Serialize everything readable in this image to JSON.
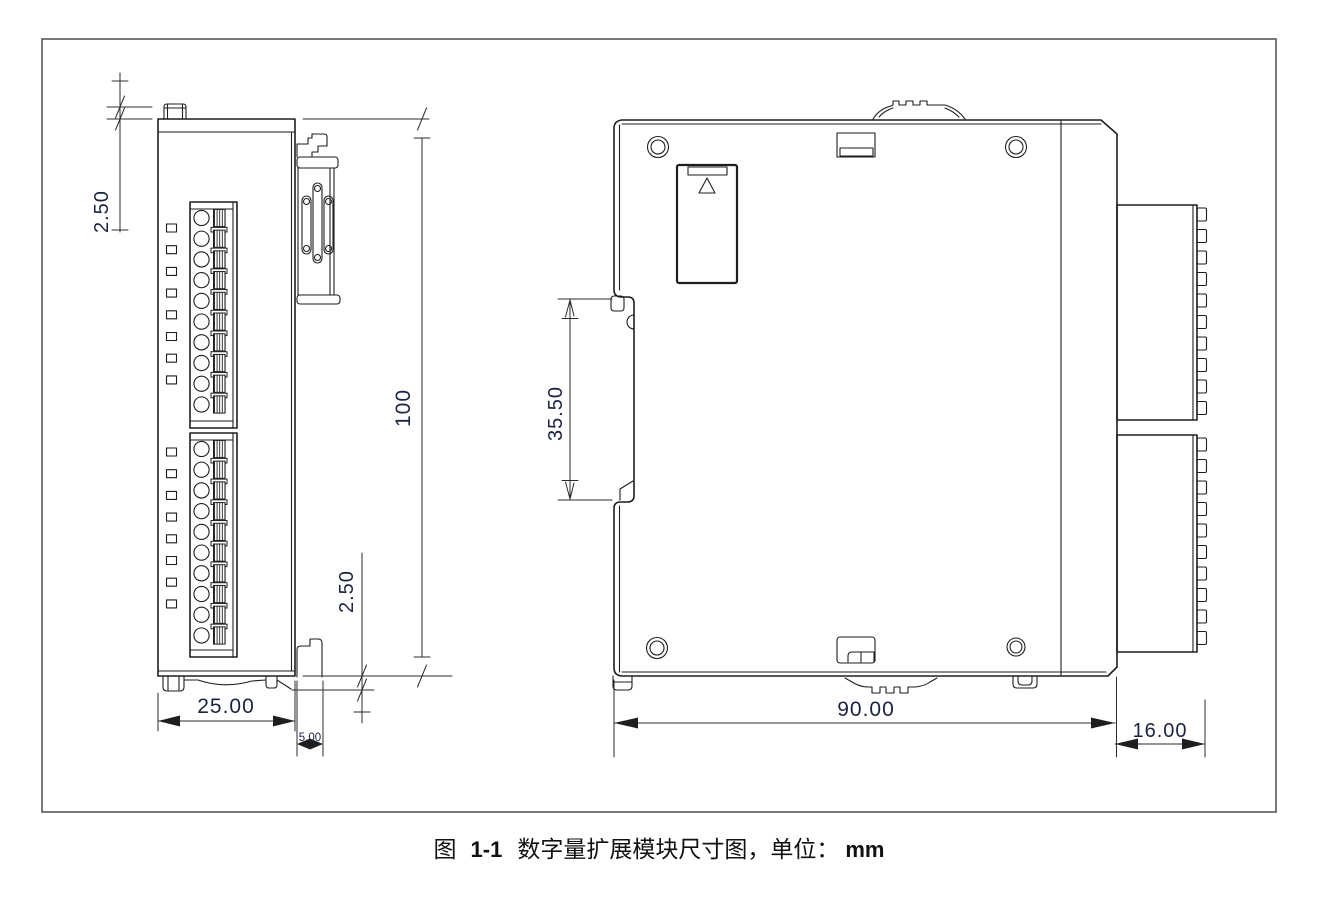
{
  "caption": {
    "fig_label": "图",
    "figure_number": "1-1",
    "title": "数字量扩展模块尺寸图，单位：",
    "unit": "mm"
  },
  "dimensions": {
    "front_top_offset": "2.50",
    "front_height": "100",
    "front_width": "25.00",
    "front_bottom_offset": "2.50",
    "rear_hook_depth": "5.00",
    "din_rail_slot_height": "35.50",
    "side_depth": "90.00",
    "connector_depth": "16.00"
  },
  "components": {
    "led_groups": 2,
    "led_indicators_per_group": 8,
    "terminal_blocks": 2,
    "terminals_per_block": 10,
    "connector_blocks": 2,
    "ridges_per_connector": 10,
    "screw_holes": 4
  },
  "icons": {
    "door_triangle": "△"
  },
  "colors": {
    "line": "#1e1e1e",
    "dimension": "#2c2c30",
    "dimension_text": "#1c2340",
    "frame": "#58585a",
    "background": "#ffffff"
  }
}
